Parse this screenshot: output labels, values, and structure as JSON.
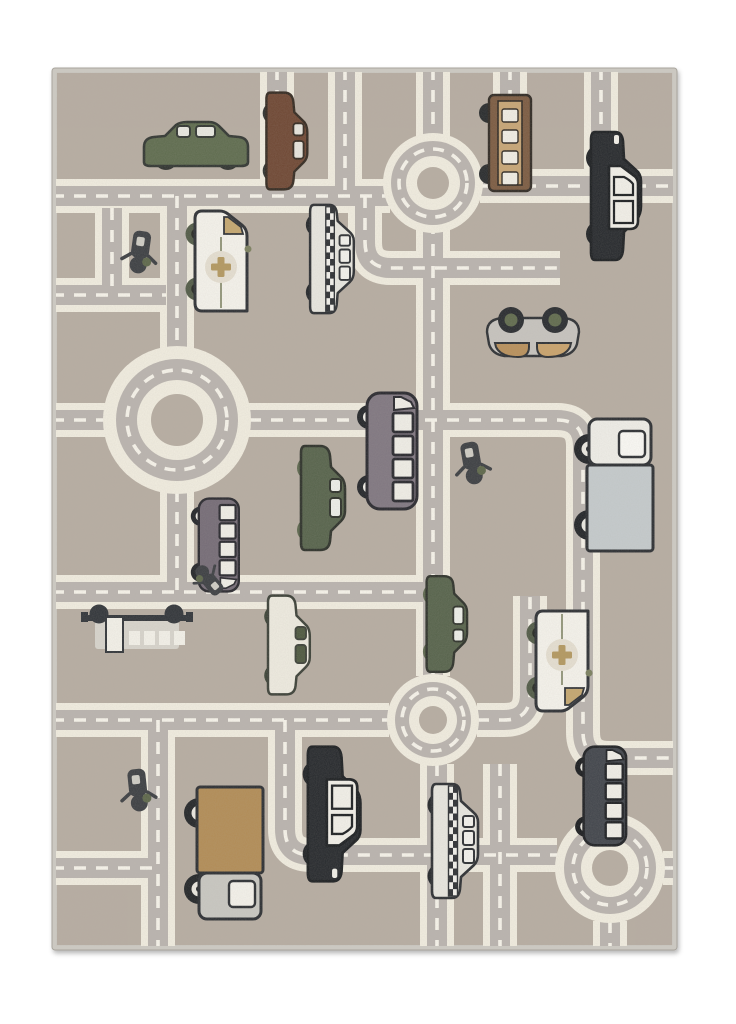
{
  "scene": {
    "background": "#ffffff"
  },
  "rug": {
    "x": 52,
    "y": 68,
    "width": 625,
    "height": 882,
    "colors": {
      "binding": "#cbc8c1",
      "bindingEdge": "#a9a59d",
      "field": "#b7ada2",
      "roadGray": "#bab4af",
      "cream": "#f2eee1",
      "dash": "#f8f5ec"
    }
  },
  "roads": {
    "creamWidth": 34,
    "grayWidth": 20,
    "dashWidth": 3.6,
    "dashPattern": "12 10",
    "cornerRadius": 26,
    "paths": [
      [
        [
          277,
          68
        ],
        [
          277,
          196
        ]
      ],
      [
        [
          52,
          196
        ],
        [
          390,
          196
        ]
      ],
      [
        [
          433,
          68
        ],
        [
          433,
          676
        ]
      ],
      [
        [
          510,
          68
        ],
        [
          510,
          186
        ]
      ],
      [
        [
          601,
          68
        ],
        [
          601,
          186
        ]
      ],
      [
        [
          480,
          186
        ],
        [
          677,
          186
        ]
      ],
      [
        [
          345,
          68
        ],
        [
          345,
          196
        ]
      ],
      [
        [
          365,
          196
        ],
        [
          365,
          268
        ],
        [
          560,
          268
        ]
      ],
      [
        [
          249,
          420
        ],
        [
          583,
          420
        ],
        [
          583,
          758
        ],
        [
          677,
          758
        ]
      ],
      [
        [
          52,
          420
        ],
        [
          106,
          420
        ]
      ],
      [
        [
          177,
          196
        ],
        [
          177,
          350
        ]
      ],
      [
        [
          177,
          490
        ],
        [
          177,
          592
        ]
      ],
      [
        [
          52,
          295
        ],
        [
          166,
          295
        ]
      ],
      [
        [
          112,
          208
        ],
        [
          112,
          295
        ]
      ],
      [
        [
          52,
          592
        ],
        [
          433,
          592
        ]
      ],
      [
        [
          52,
          720
        ],
        [
          389,
          720
        ]
      ],
      [
        [
          477,
          720
        ],
        [
          530,
          720
        ],
        [
          530,
          596
        ]
      ],
      [
        [
          158,
          720
        ],
        [
          158,
          950
        ]
      ],
      [
        [
          52,
          868
        ],
        [
          158,
          868
        ]
      ],
      [
        [
          437,
          764
        ],
        [
          437,
          950
        ]
      ],
      [
        [
          500,
          764
        ],
        [
          500,
          950
        ]
      ],
      [
        [
          462,
          855
        ],
        [
          557,
          855
        ]
      ],
      [
        [
          603,
          756
        ],
        [
          603,
          815
        ]
      ],
      [
        [
          663,
          868
        ],
        [
          677,
          868
        ]
      ],
      [
        [
          610,
          921
        ],
        [
          610,
          950
        ]
      ],
      [
        [
          285,
          720
        ],
        [
          285,
          855
        ],
        [
          437,
          855
        ]
      ]
    ]
  },
  "roundabouts": [
    {
      "cx": 177,
      "cy": 420,
      "rOut": 74,
      "rRoad": 61,
      "rIn": 40,
      "rCore": 26,
      "rDash": 50
    },
    {
      "cx": 433,
      "cy": 183,
      "rOut": 50,
      "rRoad": 42,
      "rIn": 27,
      "rCore": 16,
      "rDash": 34
    },
    {
      "cx": 433,
      "cy": 720,
      "rOut": 46,
      "rRoad": 38,
      "rIn": 24,
      "rCore": 14,
      "rDash": 31
    },
    {
      "cx": 610,
      "cy": 868,
      "rOut": 55,
      "rRoad": 46,
      "rIn": 29,
      "rCore": 18,
      "rDash": 37
    }
  ],
  "palettes": {
    "line": "#2e3236",
    "oliveCar": {
      "body": "#5d6b4d",
      "window": "#e9e9e2",
      "wheel": "#2c2f2c",
      "hub": "#6b7557",
      "line": "#2f3430"
    },
    "oliveCar2": {
      "body": "#55624a",
      "window": "#eef0ea",
      "wheel": "#5b664c",
      "hub": "#23261f",
      "line": "#2b2f28"
    },
    "brownCar": {
      "body": "#6e4632",
      "window": "#e8e6de",
      "wheel": "#2c2f2c",
      "hub": "#667050",
      "line": "#32281f"
    },
    "ladderTruck": {
      "body": "#7b5a40",
      "tan": "#c8a675",
      "white": "#f2efe6",
      "wheel": "#26292b",
      "line": "#2e2822"
    },
    "police": {
      "body": "#24272b",
      "white": "#f3f1ea",
      "wheel": "#1d2023",
      "hub": "#f3f1ea",
      "line": "#191c1f"
    },
    "ambulance": {
      "body": "#f6f4ed",
      "glass": "#c5a76f",
      "cross": "#b3985f",
      "crossbg": "#e6e0d2",
      "accent": "#7a7f5e",
      "wheel": "#4f5945",
      "hub": "#22251f",
      "line": "#2b2e33"
    },
    "taxi": {
      "body": "#e9e8e1",
      "window": "#f4f3ee",
      "wheel": "#212428",
      "hub": "#f0eee8",
      "checker": "#2b2e32",
      "line": "#2a2d31"
    },
    "purpleBus": {
      "body": "#7f7680",
      "window": "#f1efe8",
      "wheel": "#202327",
      "hub": "#efede6",
      "line": "#26262c"
    },
    "smallVan": {
      "body": "#746b76",
      "window": "#f1efe8",
      "wheel": "#202327",
      "hub": "#efede6",
      "line": "#26262c"
    },
    "darkBus": {
      "body": "#3f434a",
      "window": "#f2f0e9",
      "wheel": "#17191c",
      "hub": "#e8e6df",
      "line": "#1b1d21"
    },
    "truckGray": {
      "cargo": "#c5cbcd",
      "cab": "#f0efe9",
      "window": "#fbfaf6",
      "wheel": "#1f2226",
      "hub": "#eceae3",
      "hubDot": true,
      "line": "#2a2d31"
    },
    "truckTan": {
      "cargo": "#b28c55",
      "cab": "#c9c8c2",
      "window": "#f5f3ec",
      "wheel": "#202326",
      "hub": "#ece9e1",
      "hubDot": true,
      "line": "#2a2d31"
    },
    "creamCar": {
      "body": "#efece1",
      "window": "#4c573e",
      "wheel": "#3a4235",
      "hub": "#1e221c",
      "line": "#3a3f36"
    },
    "topcar": {
      "body": "#c7c4bf",
      "wheel": "#26292d",
      "hub": "#5f6a4c",
      "seatL": "#b9905a",
      "seatR": "#caa36b",
      "line": "#2b2e32"
    },
    "topbus": {
      "dark": "#2f3338",
      "body": "#d8d5cd",
      "white": "#f4f2ea"
    },
    "scooter": {
      "dark": "#3a3d41",
      "olive": "#5c6649",
      "light": "#cfcdc5"
    }
  },
  "vehicles": [
    {
      "name": "green-car",
      "type": "car",
      "x": 196,
      "y": 146,
      "rot": 0,
      "flip": false,
      "scale": 1.0,
      "palette": "oliveCar"
    },
    {
      "name": "brown-car",
      "type": "car",
      "x": 285,
      "y": 141,
      "rot": 90,
      "flip": false,
      "scale": 0.93,
      "palette": "brownCar"
    },
    {
      "name": "fire-ladder-truck",
      "type": "ladder",
      "x": 510,
      "y": 143,
      "rot": 90,
      "flip": false,
      "scale": 1.0,
      "palette": "ladderTruck"
    },
    {
      "name": "police-car",
      "type": "police",
      "x": 613,
      "y": 196,
      "rot": -90,
      "flip": true,
      "scale": 1.0,
      "palette": "police"
    },
    {
      "name": "ambulance",
      "type": "van",
      "x": 221,
      "y": 261,
      "rot": -90,
      "flip": true,
      "scale": 1.0,
      "palette": "ambulance"
    },
    {
      "name": "taxi",
      "type": "taxi",
      "x": 331,
      "y": 259,
      "rot": -90,
      "flip": true,
      "scale": 0.95,
      "palette": "taxi"
    },
    {
      "name": "scooter-rider-1",
      "type": "scooter",
      "x": 140,
      "y": 252,
      "rot": 8,
      "flip": false,
      "scale": 1.0,
      "palette": "scooter"
    },
    {
      "name": "top-view-car",
      "type": "topcar",
      "x": 533,
      "y": 338,
      "rot": 0,
      "flip": false,
      "scale": 1.0,
      "palette": "topcar"
    },
    {
      "name": "purple-minibus",
      "type": "bus",
      "x": 391,
      "y": 451,
      "rot": -90,
      "flip": true,
      "scale": 1.0,
      "palette": "purpleBus"
    },
    {
      "name": "olive-car-1",
      "type": "car",
      "x": 321,
      "y": 498,
      "rot": 90,
      "flip": false,
      "scale": 1.0,
      "palette": "oliveCar2"
    },
    {
      "name": "scooter-rider-2",
      "type": "scooter",
      "x": 472,
      "y": 463,
      "rot": -10,
      "flip": false,
      "scale": 1.0,
      "palette": "scooter"
    },
    {
      "name": "box-truck-gray",
      "type": "truck",
      "x": 619,
      "y": 483,
      "rot": -90,
      "flip": true,
      "scale": 1.0,
      "palette": "truckGray"
    },
    {
      "name": "small-van",
      "type": "bus",
      "x": 218,
      "y": 545,
      "rot": 90,
      "flip": false,
      "scale": 0.8,
      "palette": "smallVan"
    },
    {
      "name": "moped-top",
      "type": "scooter",
      "x": 209,
      "y": 580,
      "rot": 140,
      "flip": false,
      "scale": 0.8,
      "palette": "scooter"
    },
    {
      "name": "bus-top-view",
      "type": "topbus",
      "x": 137,
      "y": 628,
      "rot": 0,
      "flip": false,
      "scale": 1.0,
      "palette": "topbus"
    },
    {
      "name": "cream-car",
      "type": "car",
      "x": 287,
      "y": 645,
      "rot": 90,
      "flip": false,
      "scale": 0.95,
      "palette": "creamCar"
    },
    {
      "name": "olive-car-2",
      "type": "car",
      "x": 445,
      "y": 624,
      "rot": -90,
      "flip": true,
      "scale": 0.92,
      "palette": "oliveCar2"
    },
    {
      "name": "ambulance-2",
      "type": "van",
      "x": 562,
      "y": 661,
      "rot": 90,
      "flip": false,
      "scale": 1.0,
      "palette": "ambulance"
    },
    {
      "name": "dark-minibus",
      "type": "bus",
      "x": 604,
      "y": 796,
      "rot": -90,
      "flip": true,
      "scale": 0.85,
      "palette": "darkBus"
    },
    {
      "name": "taxi-2",
      "type": "taxi",
      "x": 454,
      "y": 841,
      "rot": -90,
      "flip": true,
      "scale": 1.0,
      "palette": "taxi"
    },
    {
      "name": "police-car-2",
      "type": "police",
      "x": 331,
      "y": 814,
      "rot": 90,
      "flip": false,
      "scale": 1.05,
      "palette": "police"
    },
    {
      "name": "box-truck-tan",
      "type": "truck",
      "x": 229,
      "y": 855,
      "rot": 90,
      "flip": false,
      "scale": 1.0,
      "palette": "truckTan"
    },
    {
      "name": "scooter-rider-3",
      "type": "scooter",
      "x": 138,
      "y": 790,
      "rot": -6,
      "flip": false,
      "scale": 1.0,
      "palette": "scooter"
    }
  ]
}
